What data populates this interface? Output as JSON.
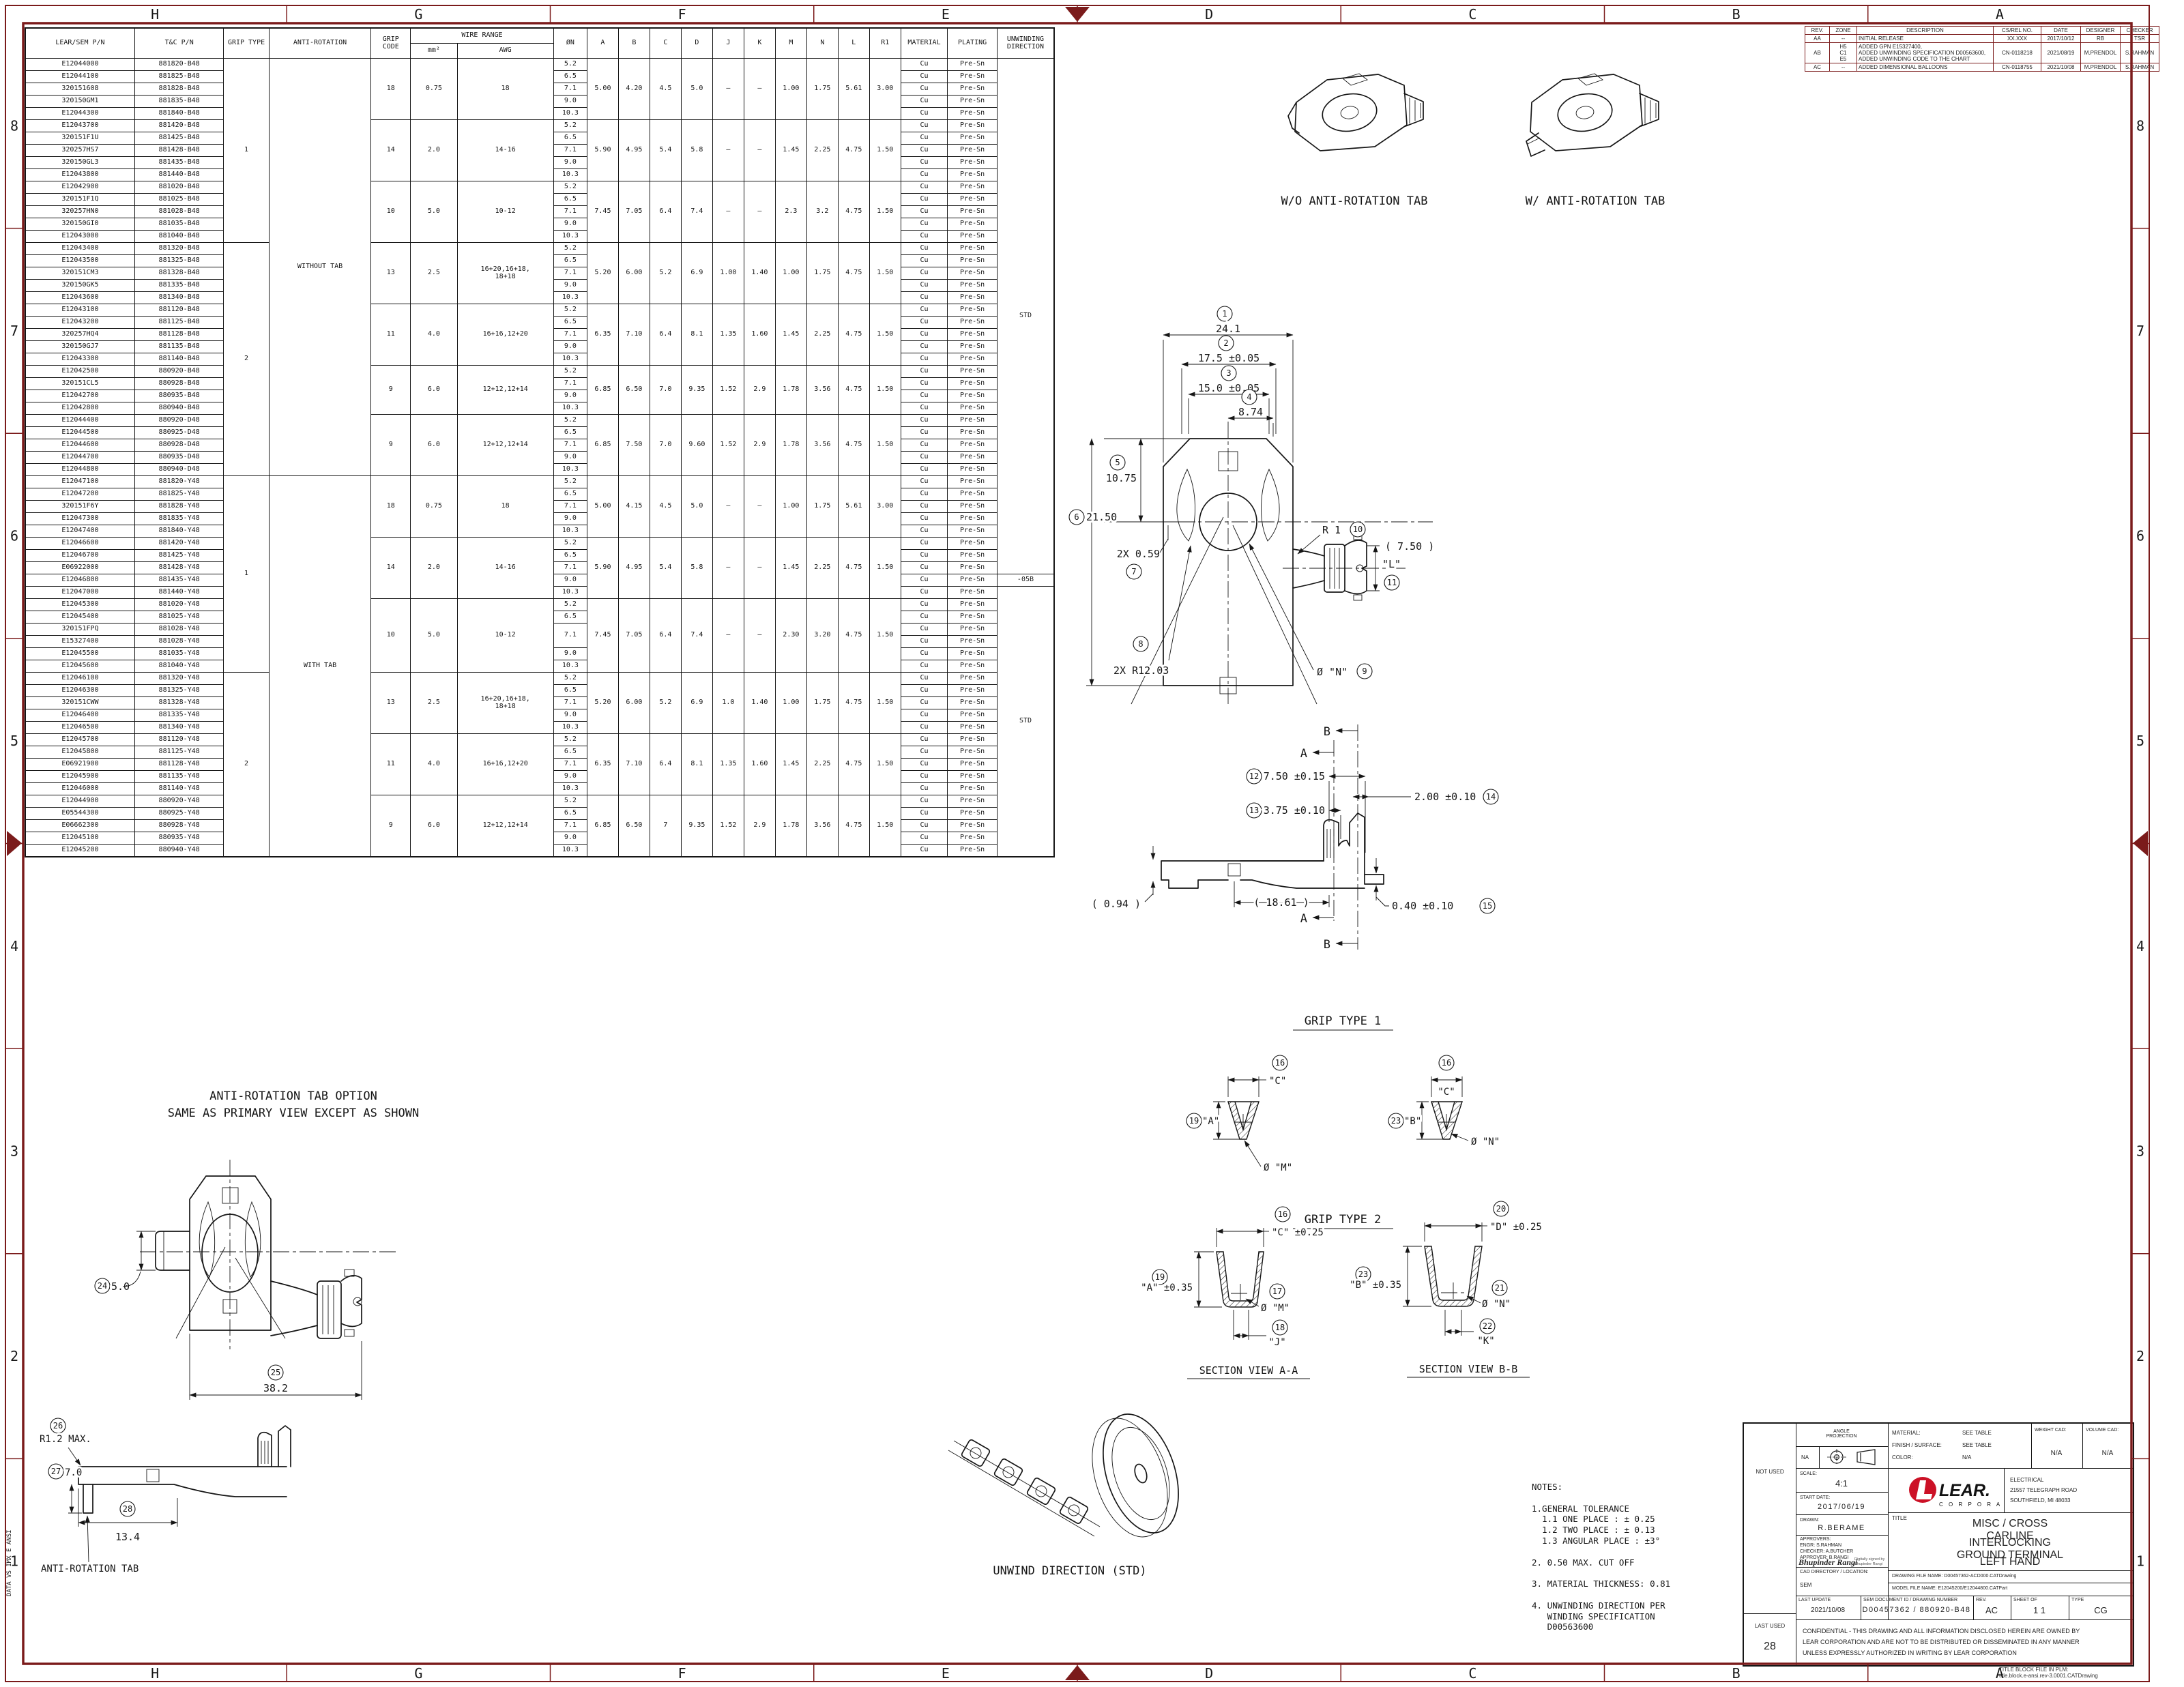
{
  "colors": {
    "frame": "#7b1b1b",
    "line": "#161616",
    "lear_red": "#cc1126"
  },
  "zones": {
    "top": [
      "H",
      "G",
      "F",
      "E",
      "D",
      "C",
      "B",
      "A"
    ],
    "left": [
      "8",
      "7",
      "6",
      "5",
      "4",
      "3",
      "2",
      "1"
    ]
  },
  "edge_text": "DATA VS IMX E ANSI",
  "parts_table": {
    "headers": {
      "pn": "LEAR/SEM P/N",
      "tc": "T&C P/N",
      "grip": "GRIP TYPE",
      "anti": "ANTI-ROTATION",
      "code": "GRIP\nCODE",
      "wire": "WIRE RANGE",
      "mm2": "mm²",
      "awg": "AWG",
      "on": "ØN",
      "material": "MATERIAL",
      "plating": "PLATING",
      "unwinding": "UNWINDING\nDIRECTION"
    },
    "dim_columns": [
      "A",
      "B",
      "C",
      "D",
      "J",
      "K",
      "M",
      "N",
      "L",
      "R1"
    ],
    "material_value": "Cu",
    "plating_value": "Pre-Sn",
    "grip_type_spans": [
      {
        "label": "1",
        "rows": 15
      },
      {
        "label": "2",
        "rows": 19
      },
      {
        "label": "1",
        "rows": 16
      },
      {
        "label": "2",
        "rows": 15
      }
    ],
    "anti_rotation_spans": [
      {
        "label": "WITHOUT TAB",
        "rows": 34
      },
      {
        "label": "WITH TAB",
        "rows": 31
      }
    ],
    "unwinding_spans": [
      {
        "label": "STD",
        "rows": 42
      },
      {
        "label": "-05B",
        "rows": 1
      },
      {
        "label": "STD",
        "rows": 22
      }
    ],
    "groups": [
      {
        "grip_code": "18",
        "mm2": "0.75",
        "awg": "18",
        "dims": [
          "5.00",
          "4.20",
          "4.5",
          "5.0",
          "–",
          "–",
          "1.00",
          "1.75",
          "5.61",
          "3.00"
        ],
        "rows": [
          {
            "pn": "E12044000",
            "tc": "881820-B48",
            "on": "5.2"
          },
          {
            "pn": "E12044100",
            "tc": "881825-B48",
            "on": "6.5"
          },
          {
            "pn": "320151608",
            "tc": "881828-B48",
            "on": "7.1"
          },
          {
            "pn": "320150GM1",
            "tc": "881835-B48",
            "on": "9.0"
          },
          {
            "pn": "E12044300",
            "tc": "881840-B48",
            "on": "10.3"
          }
        ]
      },
      {
        "grip_code": "14",
        "mm2": "2.0",
        "awg": "14-16",
        "dims": [
          "5.90",
          "4.95",
          "5.4",
          "5.8",
          "–",
          "–",
          "1.45",
          "2.25",
          "4.75",
          "1.50"
        ],
        "rows": [
          {
            "pn": "E12043700",
            "tc": "881420-B48",
            "on": "5.2"
          },
          {
            "pn": "320151F1U",
            "tc": "881425-B48",
            "on": "6.5"
          },
          {
            "pn": "320257HS7",
            "tc": "881428-B48",
            "on": "7.1"
          },
          {
            "pn": "320150GL3",
            "tc": "881435-B48",
            "on": "9.0"
          },
          {
            "pn": "E12043800",
            "tc": "881440-B48",
            "on": "10.3"
          }
        ]
      },
      {
        "grip_code": "10",
        "mm2": "5.0",
        "awg": "10-12",
        "dims": [
          "7.45",
          "7.05",
          "6.4",
          "7.4",
          "–",
          "–",
          "2.3",
          "3.2",
          "4.75",
          "1.50"
        ],
        "rows": [
          {
            "pn": "E12042900",
            "tc": "881020-B48",
            "on": "5.2"
          },
          {
            "pn": "320151F1Q",
            "tc": "881025-B48",
            "on": "6.5"
          },
          {
            "pn": "320257HN0",
            "tc": "881028-B48",
            "on": "7.1"
          },
          {
            "pn": "320150GI0",
            "tc": "881035-B48",
            "on": "9.0"
          },
          {
            "pn": "E12043000",
            "tc": "881040-B48",
            "on": "10.3"
          }
        ]
      },
      {
        "grip_code": "13",
        "mm2": "2.5",
        "awg": "16+20,16+18,\n18+18",
        "dims": [
          "5.20",
          "6.00",
          "5.2",
          "6.9",
          "1.00",
          "1.40",
          "1.00",
          "1.75",
          "4.75",
          "1.50"
        ],
        "rows": [
          {
            "pn": "E12043400",
            "tc": "881320-B48",
            "on": "5.2"
          },
          {
            "pn": "E12043500",
            "tc": "881325-B48",
            "on": "6.5"
          },
          {
            "pn": "320151CM3",
            "tc": "881328-B48",
            "on": "7.1"
          },
          {
            "pn": "320150GK5",
            "tc": "881335-B48",
            "on": "9.0"
          },
          {
            "pn": "E12043600",
            "tc": "881340-B48",
            "on": "10.3"
          }
        ]
      },
      {
        "grip_code": "11",
        "mm2": "4.0",
        "awg": "16+16,12+20",
        "dims": [
          "6.35",
          "7.10",
          "6.4",
          "8.1",
          "1.35",
          "1.60",
          "1.45",
          "2.25",
          "4.75",
          "1.50"
        ],
        "rows": [
          {
            "pn": "E12043100",
            "tc": "881120-B48",
            "on": "5.2"
          },
          {
            "pn": "E12043200",
            "tc": "881125-B48",
            "on": "6.5"
          },
          {
            "pn": "320257HQ4",
            "tc": "881128-B48",
            "on": "7.1"
          },
          {
            "pn": "320150GJ7",
            "tc": "881135-B48",
            "on": "9.0"
          },
          {
            "pn": "E12043300",
            "tc": "881140-B48",
            "on": "10.3"
          }
        ]
      },
      {
        "grip_code": "9",
        "mm2": "6.0",
        "awg": "12+12,12+14",
        "dims": [
          "6.85",
          "6.50",
          "7.0",
          "9.35",
          "1.52",
          "2.9",
          "1.78",
          "3.56",
          "4.75",
          "1.50"
        ],
        "rows": [
          {
            "pn": "E12042500",
            "tc": "880920-B48",
            "on": "5.2"
          },
          {
            "pn": "320151CL5",
            "tc": "880928-B48",
            "on": "7.1"
          },
          {
            "pn": "E12042700",
            "tc": "880935-B48",
            "on": "9.0"
          },
          {
            "pn": "E12042800",
            "tc": "880940-B48",
            "on": "10.3"
          }
        ]
      },
      {
        "grip_code": "9",
        "mm2": "6.0",
        "awg": "12+12,12+14",
        "dims": [
          "6.85",
          "7.50",
          "7.0",
          "9.60",
          "1.52",
          "2.9",
          "1.78",
          "3.56",
          "4.75",
          "1.50"
        ],
        "rows": [
          {
            "pn": "E12044400",
            "tc": "880920-D48",
            "on": "5.2"
          },
          {
            "pn": "E12044500",
            "tc": "880925-D48",
            "on": "6.5"
          },
          {
            "pn": "E12044600",
            "tc": "880928-D48",
            "on": "7.1"
          },
          {
            "pn": "E12044700",
            "tc": "880935-D48",
            "on": "9.0"
          },
          {
            "pn": "E12044800",
            "tc": "880940-D48",
            "on": "10.3"
          }
        ]
      },
      {
        "grip_code": "18",
        "mm2": "0.75",
        "awg": "18",
        "dims": [
          "5.00",
          "4.15",
          "4.5",
          "5.0",
          "–",
          "–",
          "1.00",
          "1.75",
          "5.61",
          "3.00"
        ],
        "rows": [
          {
            "pn": "E12047100",
            "tc": "881820-Y48",
            "on": "5.2"
          },
          {
            "pn": "E12047200",
            "tc": "881825-Y48",
            "on": "6.5"
          },
          {
            "pn": "320151F6Y",
            "tc": "881828-Y48",
            "on": "7.1"
          },
          {
            "pn": "E12047300",
            "tc": "881835-Y48",
            "on": "9.0"
          },
          {
            "pn": "E12047400",
            "tc": "881840-Y48",
            "on": "10.3"
          }
        ]
      },
      {
        "grip_code": "14",
        "mm2": "2.0",
        "awg": "14-16",
        "dims": [
          "5.90",
          "4.95",
          "5.4",
          "5.8",
          "–",
          "–",
          "1.45",
          "2.25",
          "4.75",
          "1.50"
        ],
        "rows": [
          {
            "pn": "E12046600",
            "tc": "881420-Y48",
            "on": "5.2"
          },
          {
            "pn": "E12046700",
            "tc": "881425-Y48",
            "on": "6.5"
          },
          {
            "pn": "E06922000",
            "tc": "881428-Y48",
            "on": "7.1"
          },
          {
            "pn": "E12046800",
            "tc": "881435-Y48",
            "on": "9.0"
          },
          {
            "pn": "E12047000",
            "tc": "881440-Y48",
            "on": "10.3"
          }
        ]
      },
      {
        "grip_code": "10",
        "mm2": "5.0",
        "awg": "10-12",
        "dims": [
          "7.45",
          "7.05",
          "6.4",
          "7.4",
          "–",
          "–",
          "2.30",
          "3.20",
          "4.75",
          "1.50"
        ],
        "rows": [
          {
            "pn": "E12045300",
            "tc": "881020-Y48",
            "on": "5.2"
          },
          {
            "pn": "E12045400",
            "tc": "881025-Y48",
            "on": "6.5"
          },
          {
            "pn": "320151FPQ",
            "tc": "881028-Y48",
            "on": {
              "v": "7.1",
              "rs": 2
            }
          },
          {
            "pn": "E15327400",
            "tc": "881028-Y48",
            "on": null
          },
          {
            "pn": "E12045500",
            "tc": "881035-Y48",
            "on": "9.0"
          },
          {
            "pn": "E12045600",
            "tc": "881040-Y48",
            "on": "10.3"
          }
        ]
      },
      {
        "grip_code": "13",
        "mm2": "2.5",
        "awg": "16+20,16+18,\n18+18",
        "dims": [
          "5.20",
          "6.00",
          "5.2",
          "6.9",
          "1.0",
          "1.40",
          "1.00",
          "1.75",
          "4.75",
          "1.50"
        ],
        "rows": [
          {
            "pn": "E12046100",
            "tc": "881320-Y48",
            "on": "5.2"
          },
          {
            "pn": "E12046300",
            "tc": "881325-Y48",
            "on": "6.5"
          },
          {
            "pn": "320151CWW",
            "tc": "881328-Y48",
            "on": "7.1"
          },
          {
            "pn": "E12046400",
            "tc": "881335-Y48",
            "on": "9.0"
          },
          {
            "pn": "E12046500",
            "tc": "881340-Y48",
            "on": "10.3"
          }
        ]
      },
      {
        "grip_code": "11",
        "mm2": "4.0",
        "awg": "16+16,12+20",
        "dims": [
          "6.35",
          "7.10",
          "6.4",
          "8.1",
          "1.35",
          "1.60",
          "1.45",
          "2.25",
          "4.75",
          "1.50"
        ],
        "rows": [
          {
            "pn": "E12045700",
            "tc": "881120-Y48",
            "on": "5.2"
          },
          {
            "pn": "E12045800",
            "tc": "881125-Y48",
            "on": "6.5"
          },
          {
            "pn": "E06921900",
            "tc": "881128-Y48",
            "on": "7.1"
          },
          {
            "pn": "E12045900",
            "tc": "881135-Y48",
            "on": "9.0"
          },
          {
            "pn": "E12046000",
            "tc": "881140-Y48",
            "on": "10.3"
          }
        ]
      },
      {
        "grip_code": "9",
        "mm2": "6.0",
        "awg": "12+12,12+14",
        "dims": [
          "6.85",
          "6.50",
          "7",
          "9.35",
          "1.52",
          "2.9",
          "1.78",
          "3.56",
          "4.75",
          "1.50"
        ],
        "rows": [
          {
            "pn": "E12044900",
            "tc": "880920-Y48",
            "on": "5.2"
          },
          {
            "pn": "E05544300",
            "tc": "880925-Y48",
            "on": "6.5"
          },
          {
            "pn": "E06662300",
            "tc": "880928-Y48",
            "on": "7.1"
          },
          {
            "pn": "E12045100",
            "tc": "880935-Y48",
            "on": "9.0"
          },
          {
            "pn": "E12045200",
            "tc": "880940-Y48",
            "on": "10.3"
          }
        ]
      }
    ]
  },
  "revision_table": {
    "columns": [
      "REV.",
      "ZONE",
      "DESCRIPTION",
      "CS/REL NO.",
      "DATE",
      "DESIGNER",
      "CHECKER"
    ],
    "rows": [
      {
        "rev": "AA",
        "zone": "--",
        "desc": "INITIAL RELEASE",
        "cs": "XX.XXX",
        "date": "2017/10/12",
        "designer": "RB",
        "checker": "TSR"
      },
      {
        "rev": "AB",
        "zone": "H5\nC1\nE5",
        "desc": "ADDED GPN E15327400,\nADDED UNWINDING SPECIFICATION D00563600,\nADDED UNWINDING CODE TO THE CHART",
        "cs": "CN-0118218",
        "date": "2021/08/19",
        "designer": "M.PRENDOL",
        "checker": "S.RAHMAN"
      },
      {
        "rev": "AC",
        "zone": "--",
        "desc": "ADDED DIMENSIONAL BALLOONS",
        "cs": "CN-0118755",
        "date": "2021/10/08",
        "designer": "M.PRENDOL",
        "checker": "S.RAHMAN"
      }
    ]
  },
  "notes": {
    "lines": [
      "NOTES:",
      "",
      "1.GENERAL TOLERANCE",
      "  1.1 ONE PLACE : ± 0.25",
      "  1.2 TWO PLACE : ± 0.13",
      "  1.3 ANGULAR PLACE : ±3°",
      "",
      "2. 0.50 MAX. CUT OFF",
      "",
      "3. MATERIAL THICKNESS: 0.81",
      "",
      "4. UNWINDING DIRECTION PER",
      "   WINDING SPECIFICATION",
      "   D00563600"
    ]
  },
  "balloons": {
    "b1": "1",
    "b2": "2",
    "b3": "3",
    "b4": "4",
    "b5": "5",
    "b6": "6",
    "b7": "7",
    "b8": "8",
    "b9": "9",
    "b10": "10",
    "b11": "11",
    "b12": "12",
    "b13": "13",
    "b14": "14",
    "b15": "15",
    "b16": "16",
    "b17": "17",
    "b18": "18",
    "b19": "19",
    "b20": "20",
    "b21": "21",
    "b22": "22",
    "b23": "23",
    "b24": "24",
    "b25": "25",
    "b26": "26",
    "b27": "27",
    "b28": "28"
  },
  "drawing": {
    "top_view_left_label": "W/O ANTI-ROTATION TAB",
    "top_view_right_label": "W/ ANTI-ROTATION TAB",
    "primary": {
      "d1": "24.1",
      "d2": "17.5 ±0.05",
      "d3": "15.0 ±0.05",
      "d4": "8.74",
      "d5": "10.75",
      "d6": "21.50",
      "d7": "2X 0.59",
      "d8": "2X R12.03",
      "d9": "Ø \"N\"",
      "d10": "R 1",
      "d11_l": "\"L\"",
      "d11_v": "( 7.50 )"
    },
    "side": {
      "d12": "7.50 ±0.15",
      "d13": "3.75 ±0.10",
      "d14": "2.00 ±0.10",
      "d15": "0.40 ±0.10",
      "ref1": "( 0.94 )",
      "ref2": "( 18.61 )",
      "cut_a": "A",
      "cut_b": "B"
    },
    "grip1": {
      "title": "GRIP TYPE 1",
      "c": "\"C\"",
      "a": "\"A\"",
      "b": "\"B\"",
      "m": "Ø \"M\"",
      "n": "Ø \"N\""
    },
    "grip2": {
      "title": "GRIP TYPE 2",
      "c": "\"C\" ±0.25",
      "d": "\"D\" ±0.25",
      "a": "\"A\" ±0.35",
      "b": "\"B\" ±0.35",
      "j": "\"J\"",
      "k": "\"K\"",
      "m": "Ø \"M\"",
      "n": "Ø \"N\"",
      "sva": "SECTION VIEW A-A",
      "svb": "SECTION VIEW B-B"
    },
    "anti": {
      "t1": "ANTI-ROTATION TAB OPTION",
      "t2": "SAME AS PRIMARY VIEW EXCEPT AS SHOWN",
      "d24": "5.0",
      "d25": "38.2",
      "d26": "R1.2 MAX.",
      "d27": "7.0",
      "d28": "13.4",
      "tab": "ANTI-ROTATION TAB"
    },
    "unwind_label": "UNWIND DIRECTION (STD)"
  },
  "title_block": {
    "angle_label": "ANGLE\nPROJECTION",
    "na": "NA",
    "material_label": "MATERIAL:",
    "material_value": "SEE TABLE",
    "finish_label": "FINISH / SURFACE:",
    "finish_value": "SEE TABLE",
    "color_label": "COLOR:",
    "color_value": "N/A",
    "weight_label": "WEIGHT CAD:",
    "weight_value": "N/A",
    "volume_label": "VOLUME CAD:",
    "volume_value": "N/A",
    "not_used": "NOT USED",
    "scale_label": "SCALE:",
    "scale_value": "4:1",
    "start_label": "START DATE:",
    "start_value": "2017/06/19",
    "drawn_label": "DRAWN:",
    "drawn_value": "R.BERAME",
    "approvers_label": "APPROVERS:",
    "approver1": "ENGR: S.RAHMAN",
    "approver2": "CHECKER: A.BUTCHER",
    "approver3": "APPROVER: B.RANGI",
    "signature": "Bhupinder Rangi",
    "signature_note": "Digitally signed by\nBhupinder Rangi",
    "cad_label": "CAD DIRECTORY / LOCATION:",
    "cad_value": "SEM",
    "division": "ELECTRICAL",
    "address1": "21557 TELEGRAPH ROAD",
    "address2": "SOUTHFIELD, MI  48033",
    "logo_word": "LEAR.",
    "logo_sub": "C O R P O R A T I O N",
    "title_label": "TITLE",
    "title1": "MISC / CROSS CARLINE",
    "title2": "INTERLOCKING GROUND TERMINAL",
    "title3": "LEFT HAND",
    "drawing_file": "DRAWING FILE NAME: D00457362-ACD000.CATDrawing",
    "model_file": "MODEL FILE NAME: E12045200/E12044800.CATPart",
    "last_update_label": "LAST UPDATE",
    "last_update_value": "2021/10/08",
    "doc_label": "SEM DOCUMENT ID / DRAWING NUMBER",
    "doc_value": "D00457362 / 880920-B48",
    "rev_label": "REV.",
    "rev_value": "AC",
    "sheet_label": "SHEET    OF",
    "sheet_value": "1      1",
    "type_label": "TYPE",
    "type_value": "CG",
    "last_used_label": "LAST USED",
    "last_used_value": "28",
    "confidential": "CONFIDENTIAL - THIS DRAWING AND ALL INFORMATION DISCLOSED HEREIN ARE OWNED BY\nLEAR CORPORATION AND ARE NOT TO BE DISTRIBUTED OR DISSEMINATED IN ANY MANNER\nUNLESS EXPRESSLY AUTHORIZED IN WRITING BY LEAR CORPORATION",
    "plm_note": "TITLE BLOCK FILE IN PLM:\ntitle.block.e-ansi.rev-3.0001.CATDrawing"
  }
}
